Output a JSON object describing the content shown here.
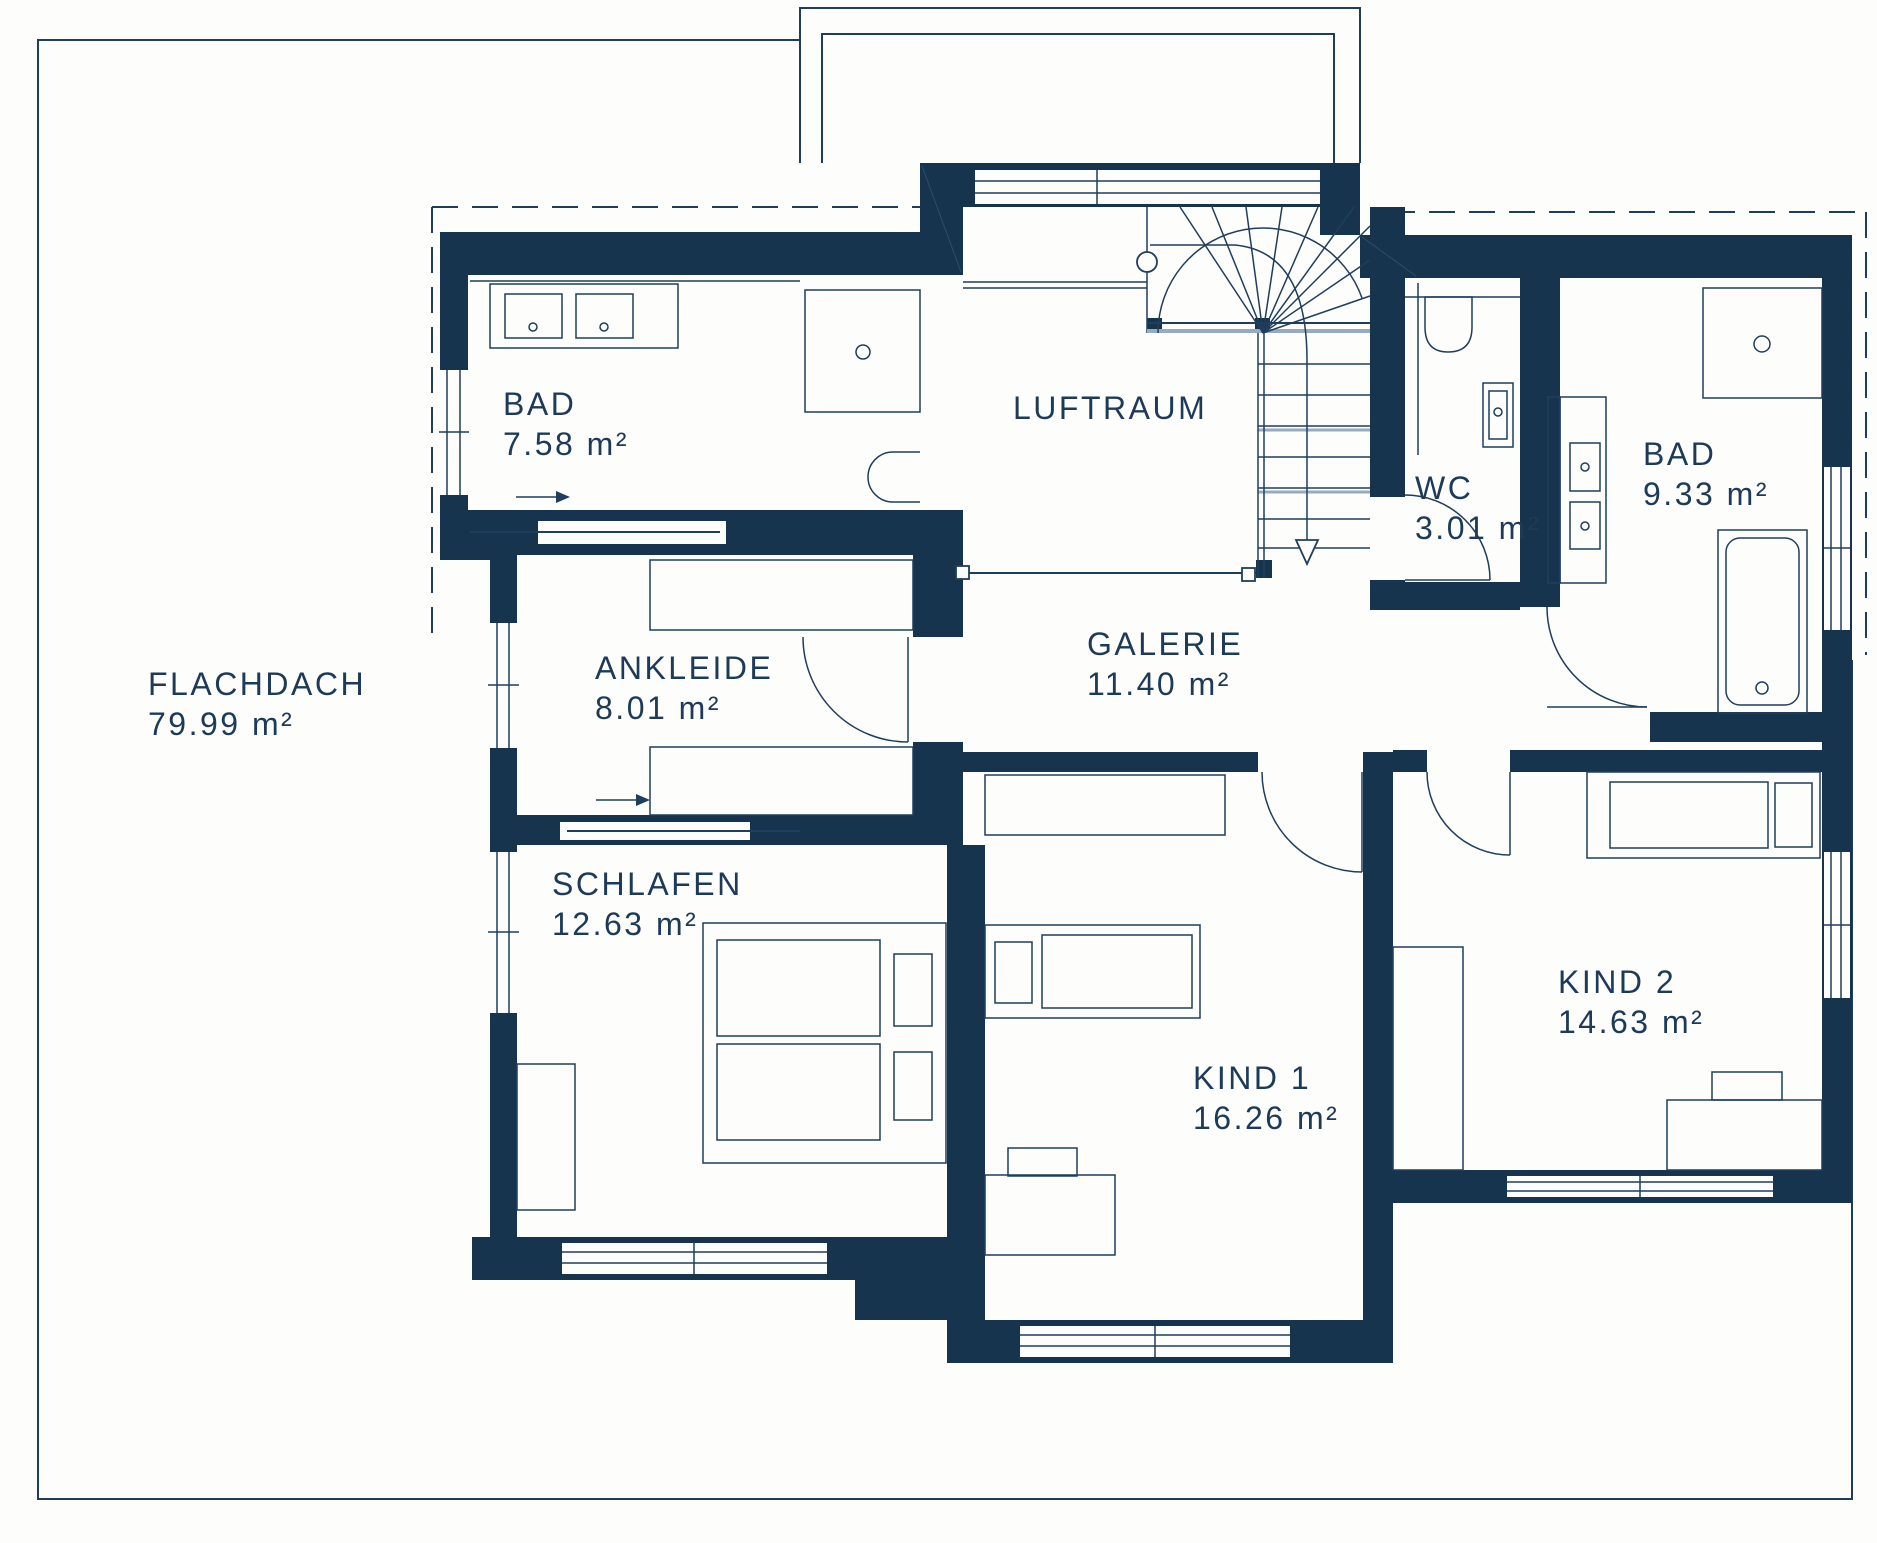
{
  "title": "Floor plan upper storey (Obergeschoss)",
  "colors": {
    "wall": "#16344e",
    "line": "#1f3e5d",
    "line_soft": "#96abbe",
    "text": "#1d3b58",
    "background": "#fdfdfb"
  },
  "rooms": [
    {
      "id": "flachdach",
      "name": "FLACHDACH",
      "area": "79.99 m²"
    },
    {
      "id": "bad-left",
      "name": "BAD",
      "area": "7.58 m²"
    },
    {
      "id": "luftraum",
      "name": "LUFTRAUM",
      "area": ""
    },
    {
      "id": "wc",
      "name": "WC",
      "area": "3.01 m²"
    },
    {
      "id": "bad-right",
      "name": "BAD",
      "area": "9.33 m²"
    },
    {
      "id": "ankleide",
      "name": "ANKLEIDE",
      "area": "8.01 m²"
    },
    {
      "id": "galerie",
      "name": "GALERIE",
      "area": "11.40 m²"
    },
    {
      "id": "schlafen",
      "name": "SCHLAFEN",
      "area": "12.63 m²"
    },
    {
      "id": "kind1",
      "name": "KIND 1",
      "area": "16.26 m²"
    },
    {
      "id": "kind2",
      "name": "KIND 2",
      "area": "14.63 m²"
    }
  ]
}
